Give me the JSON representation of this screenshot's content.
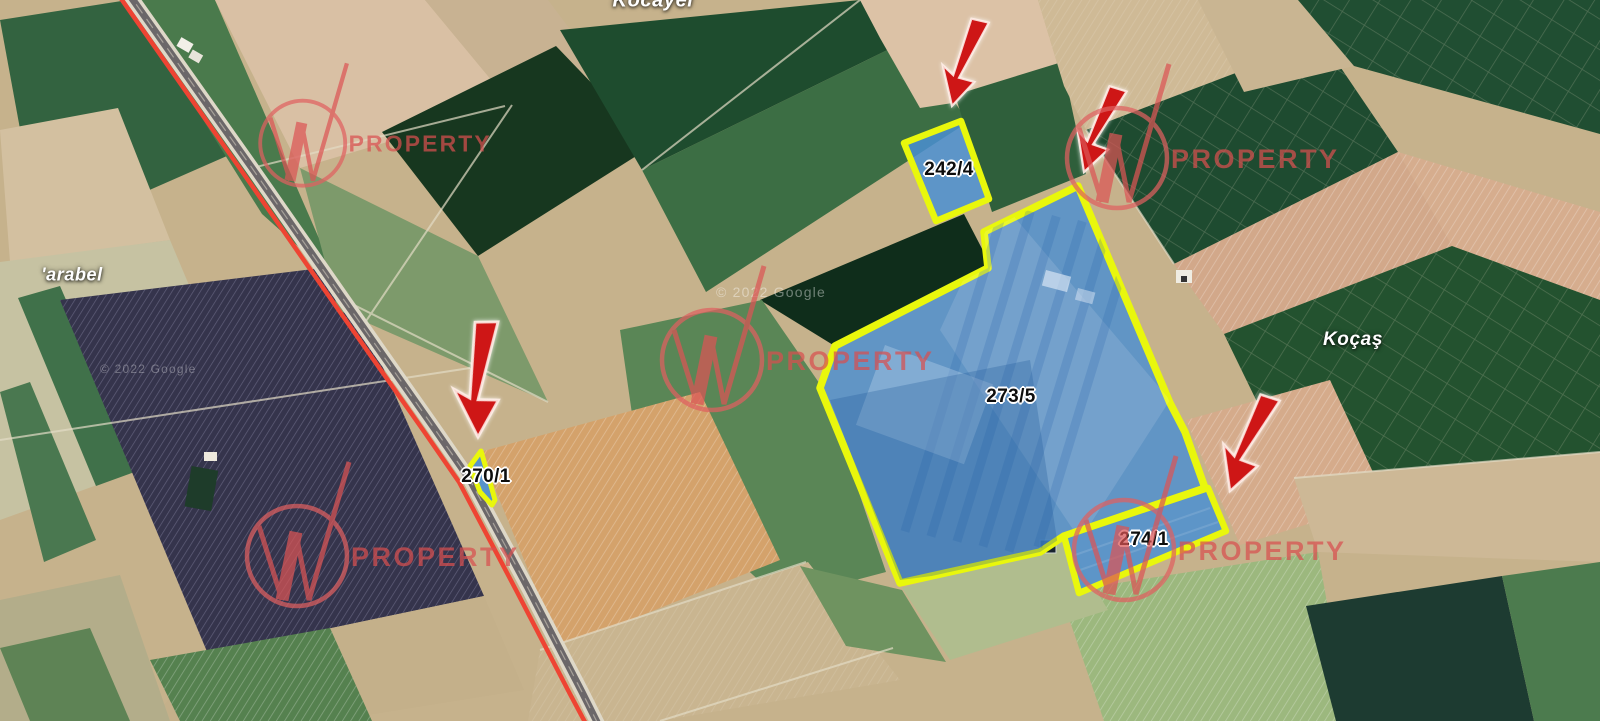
{
  "map": {
    "type": "satellite",
    "attribution": "© 2022 Google",
    "place_labels": [
      {
        "name": "Kocayel"
      },
      {
        "name": "'arabel"
      },
      {
        "name": "Koçaş"
      }
    ],
    "parcels": [
      {
        "id": "242/4",
        "highlighted": true
      },
      {
        "id": "273/5",
        "highlighted": true
      },
      {
        "id": "270/1",
        "highlighted": true
      },
      {
        "id": "274/1",
        "highlighted": true
      }
    ],
    "arrows": [
      {
        "points_to": "242/4"
      },
      {
        "points_to": "273/5"
      },
      {
        "points_to": "270/1"
      },
      {
        "points_to": "274/1"
      }
    ],
    "colors": {
      "parcel_border": "#e9f70c",
      "parcel_fill": "#4a8fd2",
      "arrow": "#ce1212",
      "road_highlight": "#ee4433",
      "watermark": "#d94f4f"
    }
  },
  "branding": {
    "logo_letter": "W",
    "logo_text": "PROPERTY"
  }
}
